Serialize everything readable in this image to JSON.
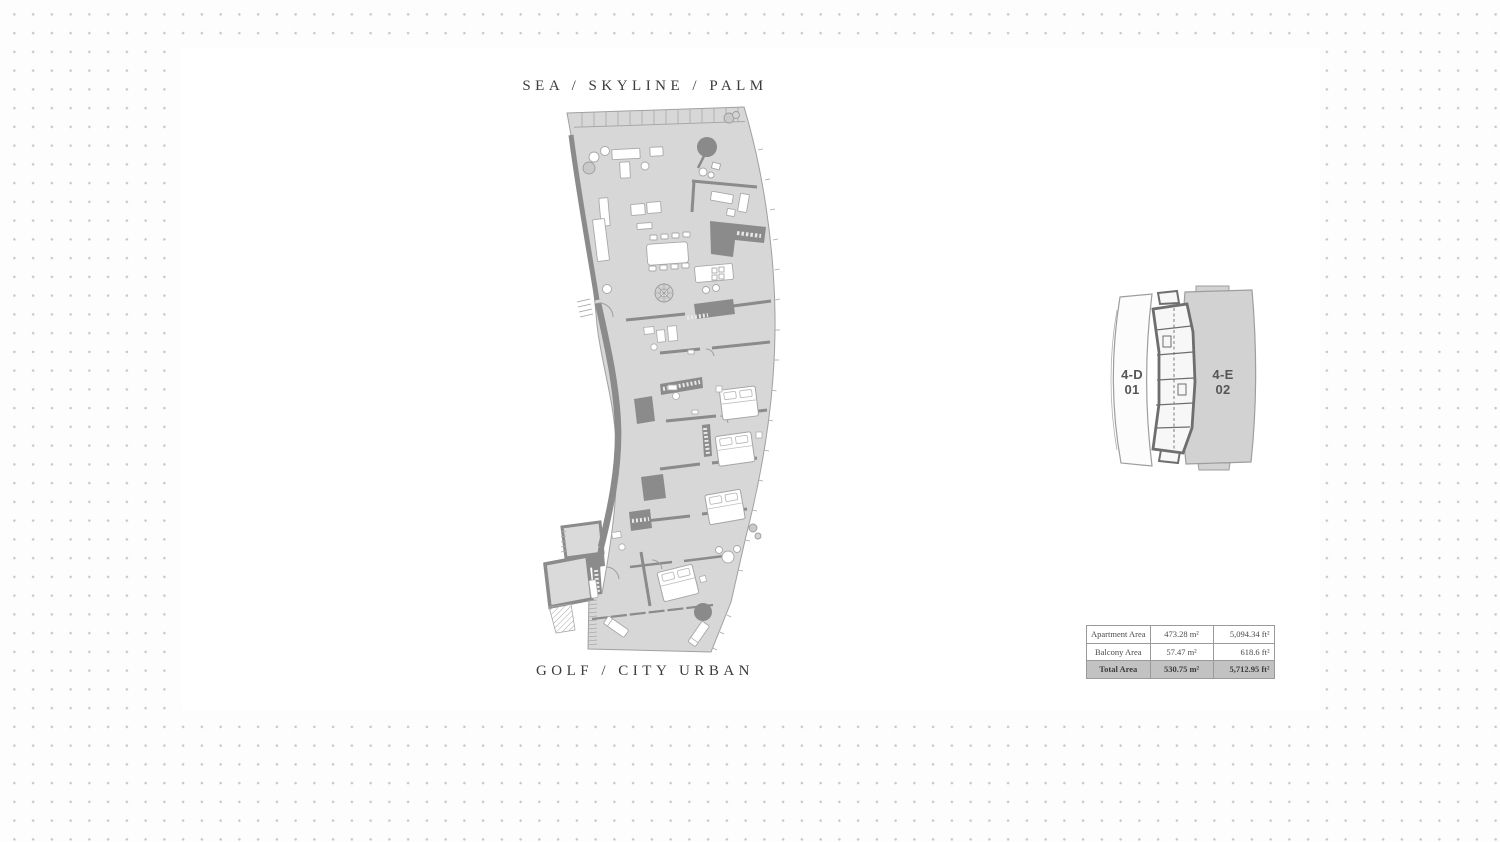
{
  "page": {
    "width": 1500,
    "height": 842,
    "background_dot_color": "#c6c6c6",
    "panel_color": "#ffffff"
  },
  "floor_plan": {
    "orientation_top": "SEA / SKYLINE / PALM",
    "orientation_bottom": "GOLF / CITY URBAN",
    "label_color": "#3b3b3b",
    "floor_fill": "#d7d7d7",
    "wall_color": "#8b8b8b"
  },
  "key_plan": {
    "units": [
      {
        "code": "4-D",
        "number": "01",
        "highlighted": false
      },
      {
        "code": "4-E",
        "number": "02",
        "highlighted": true
      }
    ],
    "label_color": "#565656",
    "highlight_fill": "#d2d2d2"
  },
  "area_table": {
    "rows": [
      {
        "label": "Apartment Area",
        "metric": "473.28 m²",
        "imperial": "5,094.34 ft²",
        "highlight": false
      },
      {
        "label": "Balcony Area",
        "metric": "57.47 m²",
        "imperial": "618.6 ft²",
        "highlight": false
      },
      {
        "label": "Total Area",
        "metric": "530.75 m²",
        "imperial": "5,712.95 ft²",
        "highlight": true
      }
    ],
    "border_color": "#9a9a9a",
    "highlight_bg": "#c2c2c2"
  }
}
